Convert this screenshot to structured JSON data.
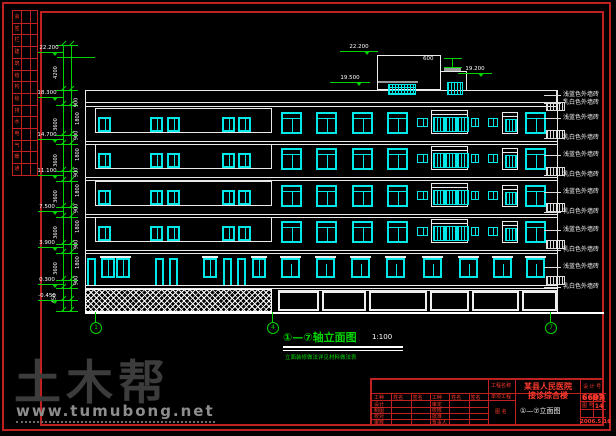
{
  "watermark": {
    "logo": "土木帮",
    "url": "www.tumubong.net"
  },
  "huiqian": {
    "chars": [
      "会",
      "签",
      "栏",
      "建",
      "筑",
      "结",
      "构",
      "给",
      "排",
      "水",
      "电",
      "气",
      "暖",
      "通"
    ]
  },
  "drawing": {
    "title": "①—⑦轴立面图",
    "scale": "1:100",
    "note": "立面装修做法详见材料做法表",
    "axis_bubbles": [
      {
        "x": 95,
        "label": "1"
      },
      {
        "x": 272,
        "label": "4"
      },
      {
        "x": 550,
        "label": "7"
      }
    ],
    "flags_left": [
      {
        "y": 52,
        "v": "22.200"
      },
      {
        "y": 97,
        "v": "18.300"
      },
      {
        "y": 139,
        "v": "14.700"
      },
      {
        "y": 175,
        "v": "11.100"
      },
      {
        "y": 211,
        "v": "7.500"
      },
      {
        "y": 247,
        "v": "3.900"
      },
      {
        "y": 284,
        "v": "0.300"
      },
      {
        "y": 300,
        "v": "-0.450"
      }
    ],
    "roof_flags": [
      {
        "x": 340,
        "y": 51,
        "v": "22.200",
        "w": 38
      },
      {
        "x": 330,
        "y": 82,
        "v": "19.500",
        "w": 40
      },
      {
        "x": 458,
        "y": 73,
        "v": "19.200",
        "w": 34
      }
    ],
    "roof_dim_label": "600",
    "dim_values_outer": [
      {
        "y": 70,
        "v": "4200"
      },
      {
        "y": 122,
        "v": "3600"
      },
      {
        "y": 158,
        "v": "3600"
      },
      {
        "y": 194,
        "v": "3600"
      },
      {
        "y": 230,
        "v": "3600"
      },
      {
        "y": 266,
        "v": "3600"
      },
      {
        "y": 296,
        "v": "450"
      }
    ],
    "dim_values_inner": [
      {
        "y": 100,
        "v": "900"
      },
      {
        "y": 116,
        "v": "1800"
      },
      {
        "y": 133,
        "v": "900"
      },
      {
        "y": 152,
        "v": "1800"
      },
      {
        "y": 170,
        "v": "900"
      },
      {
        "y": 188,
        "v": "1800"
      },
      {
        "y": 206,
        "v": "900"
      },
      {
        "y": 224,
        "v": "1800"
      },
      {
        "y": 242,
        "v": "900"
      },
      {
        "y": 260,
        "v": "1800"
      },
      {
        "y": 278,
        "v": "900"
      }
    ],
    "callouts": [
      {
        "y": 95,
        "label": "浅蓝色外墙砖"
      },
      {
        "y": 103,
        "label": "乳白色外墙砖"
      },
      {
        "y": 118,
        "label": "浅蓝色外墙砖"
      },
      {
        "y": 138,
        "label": "乳白色外墙砖"
      },
      {
        "y": 155,
        "label": "浅蓝色外墙砖"
      },
      {
        "y": 175,
        "label": "乳白色外墙砖"
      },
      {
        "y": 192,
        "label": "浅蓝色外墙砖"
      },
      {
        "y": 212,
        "label": "乳白色外墙砖"
      },
      {
        "y": 230,
        "label": "浅蓝色外墙砖"
      },
      {
        "y": 250,
        "label": "乳白色外墙砖"
      },
      {
        "y": 267,
        "label": "浅蓝色外墙砖"
      },
      {
        "y": 287,
        "label": "乳白色外墙砖"
      }
    ],
    "swatch_ys": [
      102,
      130,
      167,
      203,
      240,
      276
    ]
  },
  "elevation": {
    "outline": {
      "left": 85,
      "right": 557,
      "top": 90,
      "bottom": 312
    },
    "parapet": {
      "x": 85,
      "y": 90,
      "w": 472,
      "h": 13
    },
    "penthouse": {
      "x": 377,
      "y": 55,
      "w": 64,
      "h": 35
    },
    "rows_y": [
      108,
      144,
      181,
      217
    ],
    "left_band": {
      "x": 95,
      "w": 177,
      "h": 25,
      "wins": [
        98,
        150,
        167,
        222,
        238
      ],
      "winw": 13,
      "winh": 15
    },
    "right_big_xs": [
      281,
      316,
      352,
      387,
      525
    ],
    "right_small": [
      {
        "x": 417,
        "w": 11
      },
      {
        "x": 471,
        "w": 8
      },
      {
        "x": 488,
        "w": 10
      }
    ],
    "stair_x": 431,
    "narrow_x": 502,
    "f2": {
      "y": 258,
      "doors": [
        87,
        155,
        169,
        223,
        237
      ],
      "wins": [
        101,
        116,
        203,
        252
      ],
      "right_xs": [
        281,
        316,
        351,
        386,
        423,
        459,
        493,
        526
      ]
    },
    "storefronts": [
      [
        278,
        41
      ],
      [
        322,
        44
      ],
      [
        369,
        58
      ],
      [
        430,
        39
      ],
      [
        472,
        47
      ],
      [
        522,
        35
      ]
    ],
    "plinth": {
      "x": 85,
      "y": 289,
      "w": 187,
      "h": 23
    }
  },
  "titleblock": {
    "project_label": "工程名称",
    "project": "某县人民医院",
    "item_label": "单项工程",
    "item": "接诊综合楼",
    "design_no_label": "设 计 号",
    "design_no": "6607",
    "name_label": "图 名",
    "drawing_name": "①—⑦立面图",
    "type_label": "图 别",
    "type_value": "建施",
    "no_label": "图 号",
    "no_value": "14",
    "date_value": "2006.5.16",
    "sig": {
      "headers": [
        "工种",
        "姓名",
        "签名",
        "工种",
        "姓名",
        "签名"
      ],
      "left_rows": [
        "设计",
        "制图",
        "校对",
        "审核"
      ],
      "right_rows": [
        "审定",
        "校核",
        "批准",
        "负责人"
      ]
    }
  }
}
